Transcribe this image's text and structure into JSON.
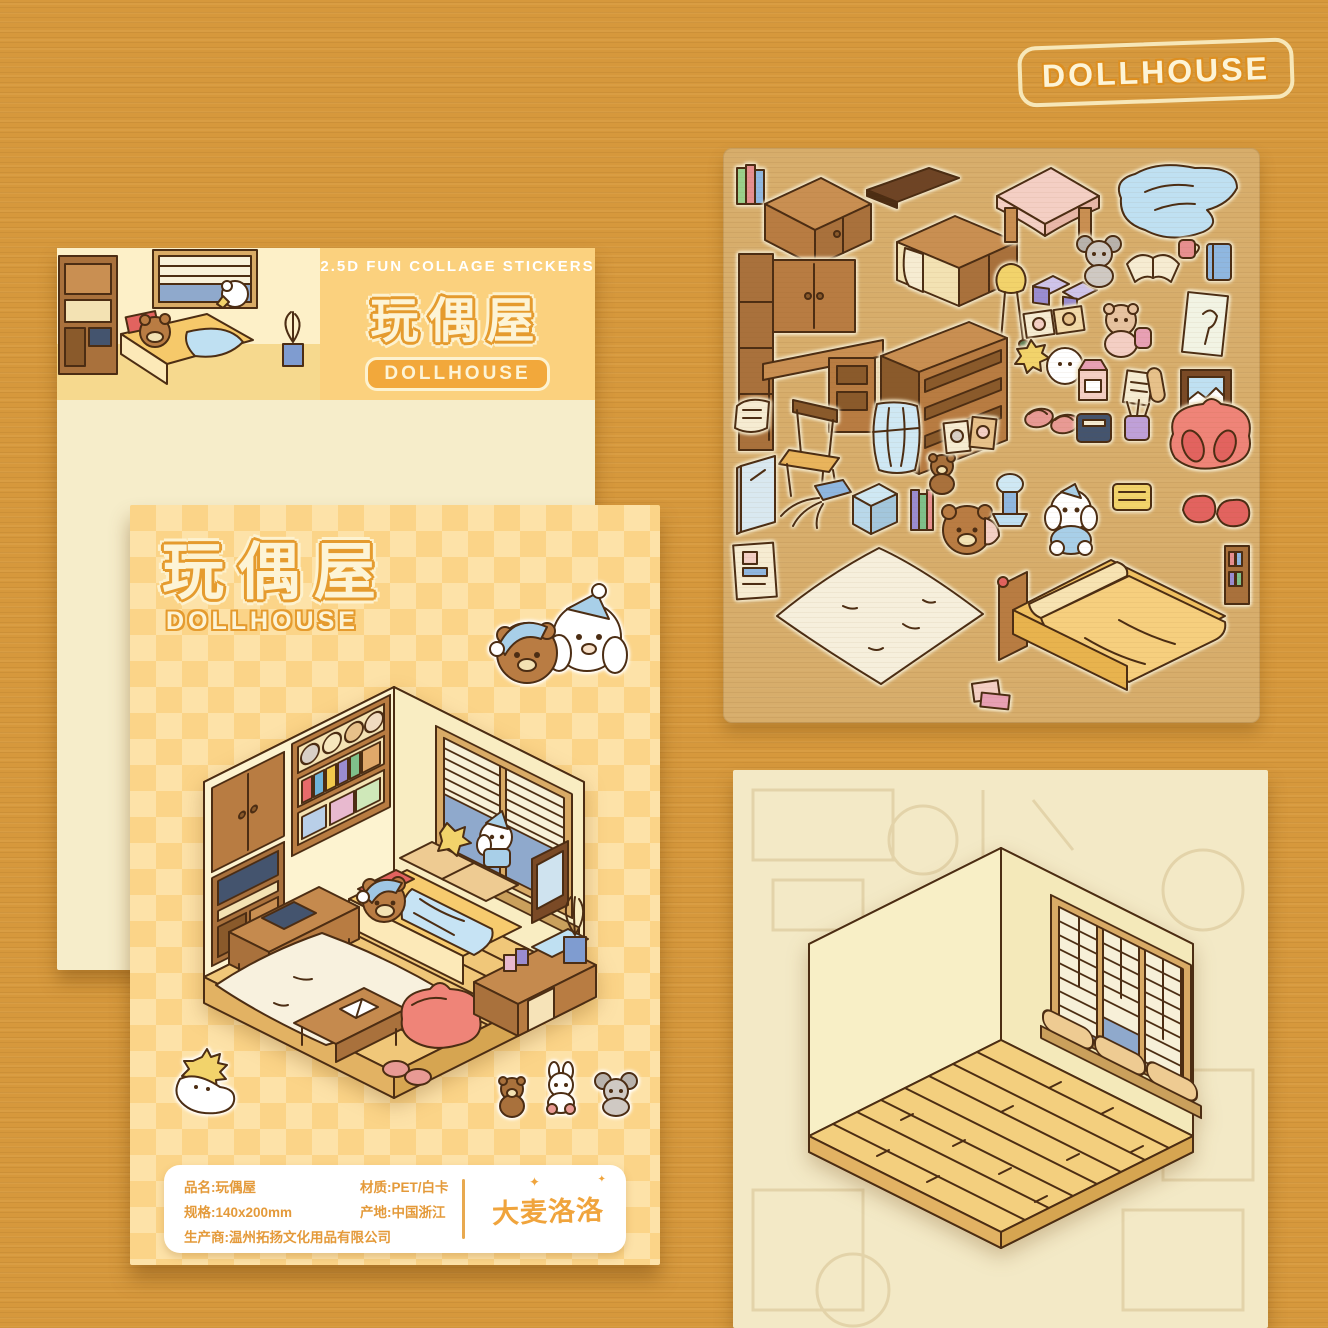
{
  "logo": {
    "text": "DOLLHOUSE"
  },
  "back_card": {
    "tagline": "2.5D FUN COLLAGE STICKERS",
    "title": "玩偶屋",
    "badge": "DOLLHOUSE"
  },
  "front_card": {
    "title": "玩偶屋",
    "subtitle": "DOLLHOUSE",
    "info": {
      "name": "品名:玩偶屋",
      "size": "规格:140x200mm",
      "manufacturer": "生产商:温州拓扬文化用品有限公司",
      "material": "材质:PET/白卡",
      "origin": "产地:中国浙江"
    },
    "brand": "大麦洛洛"
  },
  "sticker_sheet": {
    "items": [
      "mini-books",
      "top-cabinet",
      "desk-hutch",
      "shelf-plank",
      "wall-cabinet",
      "low-table",
      "blue-blanket",
      "floor-lamp",
      "storage-chests",
      "koala-plush",
      "open-book",
      "mug",
      "blue-book",
      "bookshelf",
      "pet-cards",
      "star-fluff",
      "bear-backpack",
      "milk-carton",
      "paper-scroll",
      "icecream-poster",
      "window-view-frame",
      "paper-sheet",
      "chair",
      "blue-curtain",
      "mirror",
      "plant-pot",
      "terrarium",
      "thin-books",
      "teddy-bear",
      "bear-bonnet",
      "table-lamp",
      "puppy-plush",
      "slippers",
      "photo-frames",
      "name-plate",
      "pencil-cup",
      "beanbag-chair",
      "snack-plate",
      "red-pillows",
      "poster",
      "fluffy-rug",
      "bed",
      "pink-books",
      "mini-shelf"
    ]
  },
  "colors": {
    "background": "#d6983c",
    "card_cream": "#f6edca",
    "band_orange": "#fbd17e",
    "checker_base": "#fbd488",
    "checker_light": "#fde2a8",
    "title_cream": "#fdf4d6",
    "title_outline": "#e59b2e",
    "badge_bg": "#f2a83b",
    "info_text": "#e49a3a",
    "sheet_tan": "#c7a169",
    "wood": "#b87c42",
    "wood_dark": "#8a5a2b",
    "bed_yellow": "#f7cb6e",
    "blanket_blue": "#c6e3f4",
    "beanbag_pink": "#ef8478",
    "window_blue": "#8fa9cc"
  }
}
